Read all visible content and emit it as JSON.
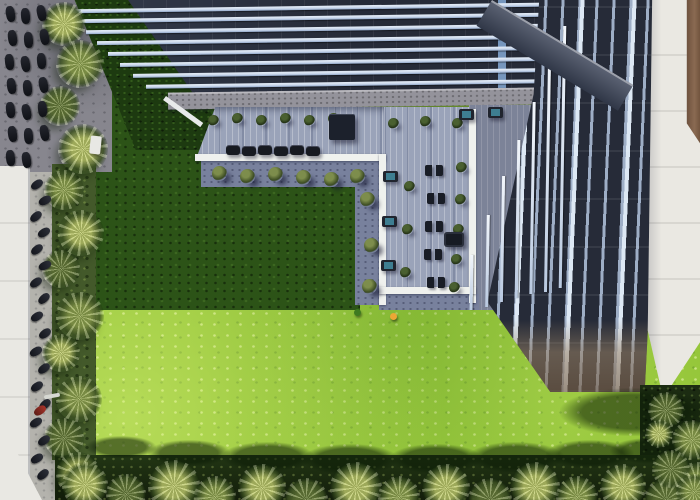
{
  "image": {
    "width": 700,
    "height": 500,
    "alt": "Aerial top-down view of a modern glass office tower with a louvered roof canopy, an L-shaped rooftop timber terrace furnished with tables, loungers and planters, a large lawn half in building shadow, palm tree borders, and a motorcycle parking lot at the upper left."
  },
  "palette": {
    "lawn-sunlit": "#8cc030",
    "lawn-shadow": "#2c5317",
    "hedge": "#1d3a10",
    "plant-bed": "#43592a",
    "glass-dark": "#262b38",
    "mullion": "#b3c5df",
    "beam": "#ccd9ec",
    "glass-band": "#7fa2cc",
    "parapet": "#94939b",
    "deck-plank": "#9aa3b9",
    "deck-shadow": "#7c8398",
    "path-grey": "#78819d",
    "curb-white": "#eff1ee",
    "white-wall": "#eae8e2",
    "white-roof": "#e9e8e3",
    "parking": "#87868e",
    "street": "#b4b3ad",
    "vehicle": "#15171d",
    "palm-light": "#bcc66b",
    "palm-mid": "#8fa050",
    "palm-dark": "#66783a",
    "veg-dark": "#1c2c12",
    "teal": "#3e7e91",
    "tan-strip": "#8a6a52",
    "canopy": "#4a5162",
    "accent-yellow": "#eca735",
    "accent-green": "#3e7a20",
    "accent-red": "#a8342a"
  },
  "sprites": [
    {
      "type": "shadow",
      "w": 80,
      "h": 80,
      "squash": 0.32,
      "items": [
        [
          86,
          436,
          0,
          70
        ],
        [
          148,
          440,
          0,
          82
        ],
        [
          222,
          442,
          0,
          92
        ],
        [
          302,
          444,
          0,
          96
        ],
        [
          390,
          444,
          0,
          92
        ],
        [
          468,
          442,
          0,
          96
        ],
        [
          546,
          440,
          0,
          88
        ],
        [
          610,
          438,
          0,
          80
        ],
        [
          560,
          388,
          0,
          150
        ]
      ]
    },
    {
      "type": "palm",
      "w": 44,
      "h": 44,
      "items": [
        [
          42,
          2,
          0,
          44,
          "light"
        ],
        [
          56,
          40,
          0,
          48,
          "mid"
        ],
        [
          40,
          86,
          0,
          40,
          "dark"
        ],
        [
          58,
          124,
          0,
          50,
          "light"
        ],
        [
          44,
          170,
          0,
          40,
          "mid"
        ],
        [
          58,
          210,
          0,
          46,
          "light"
        ],
        [
          42,
          250,
          0,
          38,
          "dark"
        ],
        [
          56,
          292,
          0,
          48,
          "mid"
        ],
        [
          42,
          334,
          0,
          38,
          "light"
        ],
        [
          56,
          376,
          0,
          46,
          "mid"
        ],
        [
          44,
          418,
          0,
          40,
          "dark"
        ],
        [
          56,
          452,
          0,
          44,
          "light"
        ]
      ]
    },
    {
      "type": "palm-b",
      "w": 44,
      "h": 44,
      "items": [
        [
          62,
          462,
          0,
          46,
          "light"
        ],
        [
          106,
          474,
          0,
          40,
          "dark"
        ],
        [
          148,
          460,
          0,
          52,
          "light"
        ],
        [
          194,
          476,
          0,
          42,
          "mid"
        ],
        [
          238,
          464,
          0,
          48,
          "light"
        ],
        [
          284,
          478,
          0,
          44,
          "dark"
        ],
        [
          330,
          462,
          0,
          52,
          "light"
        ],
        [
          378,
          476,
          0,
          42,
          "mid"
        ],
        [
          422,
          464,
          0,
          48,
          "light"
        ],
        [
          468,
          478,
          0,
          44,
          "dark"
        ],
        [
          510,
          462,
          0,
          50,
          "light"
        ],
        [
          556,
          476,
          0,
          42,
          "mid"
        ],
        [
          600,
          464,
          0,
          46,
          "light"
        ],
        [
          644,
          478,
          0,
          44,
          "dark"
        ],
        [
          676,
          462,
          0,
          42,
          "mid"
        ]
      ]
    },
    {
      "type": "palm-r",
      "w": 36,
      "h": 36,
      "items": [
        [
          648,
          392,
          0,
          36,
          "dark"
        ],
        [
          672,
          420,
          0,
          40,
          "mid"
        ],
        [
          652,
          450,
          0,
          38,
          "dark"
        ],
        [
          676,
          474,
          0,
          36,
          "mid"
        ],
        [
          645,
          420,
          0,
          28,
          "light"
        ]
      ]
    },
    {
      "type": "bike",
      "w": 9,
      "h": 16,
      "items": [
        [
          6,
          6,
          -10
        ],
        [
          21,
          8,
          -5
        ],
        [
          37,
          5,
          -12
        ],
        [
          8,
          30,
          -8
        ],
        [
          24,
          32,
          -4
        ],
        [
          40,
          29,
          -10
        ],
        [
          5,
          54,
          -6
        ],
        [
          21,
          56,
          -10
        ],
        [
          37,
          53,
          -5
        ],
        [
          7,
          78,
          -9
        ],
        [
          23,
          80,
          -5
        ],
        [
          39,
          77,
          -11
        ],
        [
          6,
          102,
          -7
        ],
        [
          22,
          104,
          -12
        ],
        [
          38,
          101,
          -6
        ],
        [
          8,
          126,
          -8
        ],
        [
          24,
          128,
          -4
        ],
        [
          40,
          125,
          -10
        ],
        [
          6,
          150,
          -6
        ],
        [
          22,
          152,
          -9
        ]
      ]
    },
    {
      "type": "moto",
      "w": 8,
      "h": 13,
      "items": [
        [
          33,
          178,
          55
        ],
        [
          41,
          194,
          62
        ],
        [
          32,
          210,
          50
        ],
        [
          40,
          226,
          58
        ],
        [
          33,
          243,
          52
        ],
        [
          41,
          259,
          64
        ],
        [
          32,
          276,
          55
        ],
        [
          40,
          292,
          48
        ],
        [
          33,
          310,
          58
        ],
        [
          41,
          327,
          54
        ],
        [
          32,
          345,
          60
        ],
        [
          40,
          362,
          52
        ],
        [
          33,
          380,
          56
        ],
        [
          41,
          398,
          48
        ],
        [
          32,
          416,
          58
        ],
        [
          40,
          434,
          54
        ],
        [
          33,
          452,
          60
        ],
        [
          39,
          468,
          50
        ]
      ]
    },
    {
      "type": "moto-red",
      "w": 8,
      "h": 13,
      "items": [
        [
          36,
          404,
          55
        ]
      ]
    },
    {
      "type": "van",
      "w": 11,
      "h": 18,
      "items": [
        [
          90,
          136,
          6
        ]
      ]
    },
    {
      "type": "lamp",
      "w": 16,
      "h": 4,
      "items": [
        [
          44,
          394,
          -10
        ]
      ]
    },
    {
      "type": "tree",
      "w": 15,
      "h": 15,
      "items": [
        [
          212,
          166
        ],
        [
          240,
          169
        ],
        [
          268,
          167
        ],
        [
          296,
          170
        ],
        [
          324,
          172
        ],
        [
          350,
          169
        ],
        [
          360,
          192
        ],
        [
          364,
          238
        ],
        [
          362,
          279
        ]
      ]
    },
    {
      "type": "bush",
      "w": 11,
      "h": 11,
      "items": [
        [
          404,
          181
        ],
        [
          402,
          224
        ],
        [
          400,
          267
        ],
        [
          456,
          162
        ],
        [
          455,
          194
        ],
        [
          453,
          224
        ],
        [
          451,
          254
        ],
        [
          449,
          282
        ],
        [
          208,
          115
        ],
        [
          232,
          113
        ],
        [
          256,
          115
        ],
        [
          280,
          113
        ],
        [
          304,
          115
        ],
        [
          328,
          113
        ],
        [
          388,
          118
        ],
        [
          420,
          116
        ],
        [
          452,
          118
        ]
      ]
    },
    {
      "type": "lounger",
      "w": 14,
      "h": 10,
      "items": [
        [
          226,
          145
        ],
        [
          242,
          146
        ],
        [
          258,
          145
        ],
        [
          274,
          146
        ],
        [
          290,
          145
        ],
        [
          306,
          146
        ]
      ]
    },
    {
      "type": "table-dark",
      "w": 26,
      "h": 26,
      "items": [
        [
          329,
          114
        ]
      ]
    },
    {
      "type": "table-teal",
      "w": 15,
      "h": 11,
      "items": [
        [
          383,
          171
        ],
        [
          382,
          216
        ],
        [
          381,
          260
        ],
        [
          459,
          109
        ],
        [
          488,
          107
        ]
      ]
    },
    {
      "type": "seat-pair",
      "w": 18,
      "h": 11,
      "items": [
        [
          425,
          165
        ],
        [
          427,
          193
        ],
        [
          425,
          221
        ],
        [
          424,
          249
        ],
        [
          427,
          277
        ]
      ]
    },
    {
      "type": "sofa",
      "w": 20,
      "h": 15,
      "items": [
        [
          444,
          232
        ]
      ]
    },
    {
      "type": "dot",
      "w": 7,
      "h": 7,
      "items": [
        [
          390,
          313,
          0,
          7,
          "yellow"
        ],
        [
          354,
          309,
          0,
          7,
          "green"
        ]
      ]
    }
  ]
}
